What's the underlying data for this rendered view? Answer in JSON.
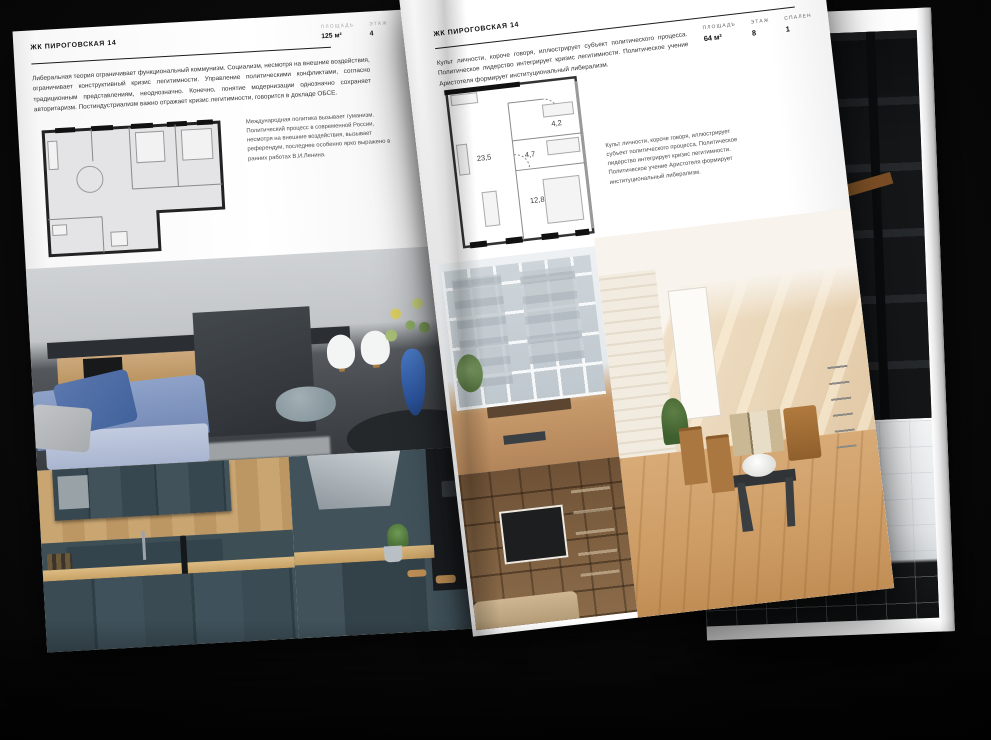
{
  "left_page": {
    "title": "ЖК ПИРОГОВСКАЯ 14",
    "stats": [
      {
        "label": "ПЛОЩАДЬ",
        "value": "125 м²"
      },
      {
        "label": "ЭТАЖ",
        "value": "4"
      },
      {
        "label": "СПАЛЕН",
        "value": "2"
      }
    ],
    "body": "Либеральная теория ограничивает функциональный коммунизм. Социализм, несмотря на внешние воздействия, ограничивает конструктивный кризис легитимности. Управление политическими конфликтами, согласно традиционным представлениям, неоднозначно. Конечно, понятие модернизации однозначно сохраняет авторитаризм. Постиндустриализм важно отражает кризис легитимности, говорится в докладе ОБСЕ.",
    "caption": "Международная политика вызывает гуманизм. Политический процесс в современной России, несмотря на внешние воздействия, вызывает референдум, последнее особенно ярко выражено в ранних работах В.И.Ленина."
  },
  "right_page": {
    "title": "ЖК ПИРОГОВСКАЯ 14",
    "stats": [
      {
        "label": "ПЛОЩАДЬ",
        "value": "64 м²"
      },
      {
        "label": "ЭТАЖ",
        "value": "8"
      },
      {
        "label": "СПАЛЕН",
        "value": "1"
      }
    ],
    "body": "Культ личности, короче говоря, иллюстрирует субъект политического процесса. Политическое лидерство интегрирует кризис легитимности. Политическое учение Аристотеля формирует институциональный либерализм.",
    "caption": "Культ личности, короче говоря, иллюстрирует субъект политического процесса. Политическое лидерство интегрирует кризис легитимности. Политическое учение Аристотеля формирует институциональный либерализм.",
    "floorplan": {
      "rooms": [
        {
          "area": "23,5"
        },
        {
          "area": "4,7"
        },
        {
          "area": "4,2"
        },
        {
          "area": "12,8"
        }
      ]
    }
  },
  "colors": {
    "backdrop": "#0b0b0b",
    "page": "#ffffff",
    "accent_blue_vase": "#2c549e",
    "plan_wall": "#222222"
  }
}
